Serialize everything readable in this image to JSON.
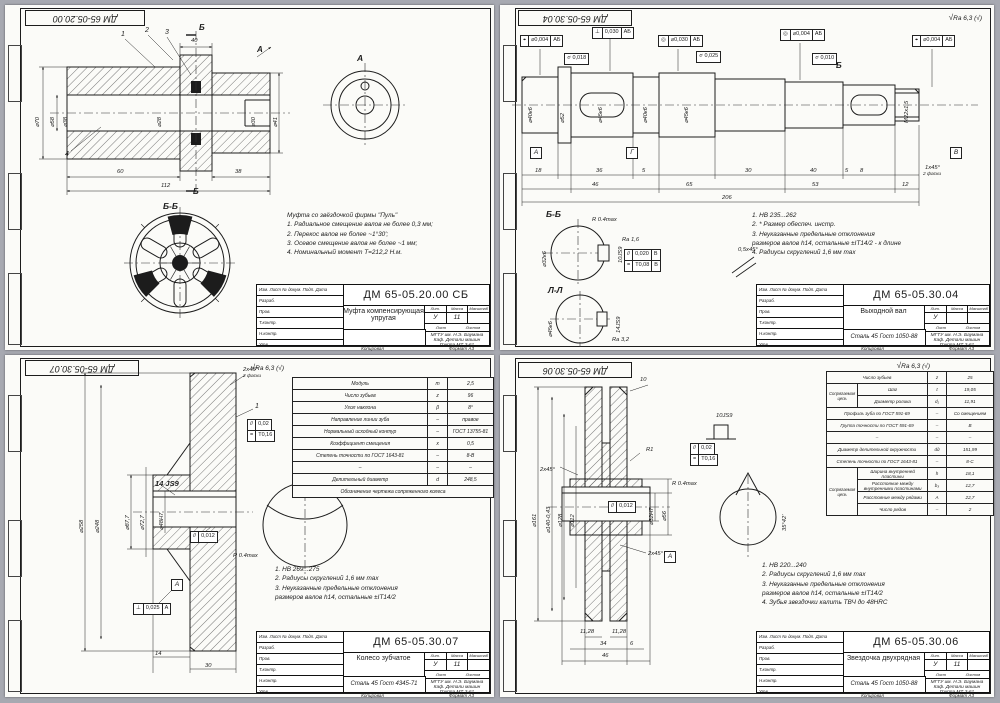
{
  "tbc": {
    "r0": "Изм. Лист  № докум.  Подп.  Дата",
    "r1": "Разраб.",
    "r2": "Пров.",
    "r3": "Т.контр.",
    "r4": "Н.контр.",
    "r5": "Утв.",
    "lit": "Лит.",
    "mass": "Масса",
    "scale": "Масштаб",
    "sheet": "Лист",
    "sheets": "Листов",
    "org1": "МГТУ им. Н.Э. Баумана",
    "org2": "Каф. Детали машин",
    "org3": "Группа МТ 3-61",
    "copied": "Копировал",
    "format": "Формат А3",
    "check": "√",
    "rough": "Ra 6,3 (√)"
  },
  "s1": {
    "corner": "ДМ 65-05.20.00",
    "labels": {
      "viewA": "А",
      "cutTop": "Б",
      "cutBottom": "Б",
      "section": "Б-Б",
      "arrowA": "А"
    },
    "callouts": [
      "1",
      "2",
      "3",
      "4"
    ],
    "dims": {
      "w40": "40",
      "d70": "⌀70",
      "d58": "⌀58",
      "d38": "⌀38",
      "d28": "⌀28",
      "d30": "⌀30",
      "d41": "⌀41",
      "l60": "60",
      "l112": "112",
      "l38": "38"
    },
    "notes": [
      "Муфта со звёздочкой фирмы \"Пуль\"",
      "1. Радиальное смещение валов не более 0,3 мм;",
      "2. Перекос валов не более ~1°30';",
      "3. Осевое смещение валов не более ~1 мм;",
      "4. Номинальный момент Т=212,2 Н.м."
    ],
    "tb": {
      "doc": "ДМ 65-05.20.00 СБ",
      "name": "Муфта компенсирующая упругая",
      "material": "",
      "lit": "У",
      "mass": "11",
      "scale": ""
    }
  },
  "s2": {
    "corner": "ДМ 65-05.30.04",
    "frames": {
      "f1s": "⌖",
      "f1v": "⌀0,004",
      "f1d": "АБ",
      "f2s": "⊥",
      "f2v": "0,030",
      "f2d": "АБ",
      "f3s": "◎",
      "f3v": "⌀0,030",
      "f3d": "АБ",
      "f4s": "◎",
      "f4v": "⌀0,004",
      "f4d": "АБ",
      "f5s": "⌖",
      "f5v": "⌀0,004",
      "f5d": "АБ",
      "f6": "⌭ 0,018",
      "f7": "⌭ 0,025",
      "f8": "⌭ 0,010",
      "k1s": "//",
      "k1v": "0,020",
      "k1d": "В",
      "k2s": "=",
      "k2v": "Т0,08",
      "k2d": "В"
    },
    "dims": {
      "d1": "⌀40к6",
      "d2": "⌀52",
      "d3": "⌀45к6",
      "d4": "⌀40к6",
      "d5": "⌀45к6",
      "thread": "М22х1,5",
      "b18": "18",
      "b36": "36",
      "b5a": "5",
      "b30": "30",
      "b40": "40",
      "b5b": "5",
      "b8": "8",
      "b46": "46",
      "b65": "65",
      "b53": "53",
      "b12": "12",
      "b206": "206",
      "cham": "1х45°",
      "cham2": "2 фаски",
      "chamd": "0,5х45°",
      "sb": "⌀32к6",
      "sbk": "10JS9",
      "sbr": "R 0.4max",
      "sbra": "Ra 1,6",
      "sl": "⌀45к6",
      "slk": "14JS9",
      "slra": "Ra 3,2"
    },
    "labels": {
      "secB": "Б-Б",
      "secL": "Л-Л",
      "dA": "А",
      "dG": "Г",
      "dB": "В",
      "cutB": "Б"
    },
    "notes": [
      "1. НВ 235...262",
      "2. * Размер обеспеч. инстр.",
      "3. Неуказанные предельные отклонения",
      "размеров валов h14, остальные ±IT14/2 - к длине",
      "4. Радиусы скруглений 1,6 мм max"
    ],
    "tb": {
      "doc": "ДМ 65-05.30.04",
      "name": "Выходной вал",
      "material": "Сталь 45 Гост 1050-88",
      "lit": "У",
      "mass": "",
      "scale": ""
    }
  },
  "s3": {
    "corner": "ДМ 65-05.30.07",
    "table": [
      [
        "Модуль",
        "m",
        "2,5"
      ],
      [
        "Число зубьев",
        "z",
        "96"
      ],
      [
        "Угол наклона",
        "β",
        "8°"
      ],
      [
        "Направление линии зуба",
        "–",
        "правое"
      ],
      [
        "Нормальный исходный контур",
        "–",
        "ГОСТ 13755-81"
      ],
      [
        "Коэффициент смещения",
        "x",
        "0,5"
      ],
      [
        "Степень точности по ГОСТ 1643-81",
        "–",
        "8-В"
      ],
      [
        "–",
        "–",
        "–"
      ],
      [
        "Делительный диаметр",
        "d",
        "248,5"
      ],
      [
        "Обозначение чертежа сопряженного колеса"
      ]
    ],
    "dims": {
      "d258": "⌀258",
      "d248": "⌀248",
      "d877": "⌀87,7",
      "d727": "⌀72,7",
      "d48": "⌀48Н7",
      "key": "14 JS9",
      "cham": "2х45°",
      "cham2": "2 фаски",
      "w30": "30",
      "w14": "14",
      "r04": "R 0.4max",
      "c1": "1"
    },
    "frames": {
      "p1s": "//",
      "p1v": "0,012",
      "p2s": "⊥",
      "p2v": "0,025",
      "p2d": "А",
      "q1s": "//",
      "q1v": "0,02",
      "q2s": "=",
      "q2v": "Т0,16",
      "dA": "А"
    },
    "notes": [
      "1. НВ 269...275",
      "2. Радиусы скруглений 1,6 мм max",
      "3. Неуказанные предельные отклонения",
      "размеров валов h14, остальные ±IT14/2"
    ],
    "tb": {
      "doc": "ДМ 65-05.30.07",
      "name": "Колесо зубчатое",
      "material": "Сталь 45 Гост 4345-71",
      "lit": "У",
      "mass": "11",
      "scale": ""
    }
  },
  "s4": {
    "corner": "ДМ 65-05.30.06",
    "table": {
      "g1": "Сопрягаемая цепь",
      "g2": "Сопрягаемая цепь",
      "r0": [
        "Число зубьев",
        "z",
        "25"
      ],
      "r1": [
        "Шаг",
        "t",
        "19,05"
      ],
      "r2": [
        "Диаметр ролика",
        "d₁",
        "11,91"
      ],
      "r3": [
        "Профиль зуба по ГОСТ 591-69",
        "–",
        "Со смещением"
      ],
      "r4": [
        "Группа точности по ГОСТ 591-69",
        "–",
        "В"
      ],
      "r5": [
        "–",
        "–",
        "–"
      ],
      "r6": [
        "Диаметр делительной окружности",
        "dд",
        "151,99"
      ],
      "r7": [
        "Степень точности по ГОСТ 1643-81",
        "–",
        "8-С"
      ],
      "r8": [
        "Ширина внутренней пластины",
        "h",
        "18,1"
      ],
      "r9": [
        "Расстояние между внутренними пластинами",
        "b₃",
        "12,7"
      ],
      "r10": [
        "Расстояние между рядами",
        "А",
        "22,7"
      ],
      "r11": [
        "Число рядов",
        "–",
        "2"
      ]
    },
    "dims": {
      "d161": "⌀161",
      "d140": "⌀140-0,43",
      "d128": "⌀128",
      "d112": "⌀112",
      "d32": "⌀32Н7",
      "d56": "⌀56",
      "cham": "2х45°",
      "key": "10JS9",
      "ang": "35°42'",
      "r1": "R1",
      "r04": "R 0.4max",
      "t10": "10",
      "b1": "11,28",
      "b2": "34",
      "b3": "6",
      "b4": "11,28",
      "b5": "46"
    },
    "frames": {
      "q1s": "//",
      "q1v": "0,02",
      "q2s": "=",
      "q2v": "Т0,16",
      "p1s": "//",
      "p1v": "0,012",
      "dA": "А"
    },
    "notes": [
      "1. НВ 220...240",
      "2. Радиусы скруглений 1,6 мм max",
      "3. Неуказанные предельные отклонения",
      "размеров валов h14, остальные ±IT14/2",
      "4. Зубья звездочки калить ТВЧ до 48HRC"
    ],
    "tb": {
      "doc": "ДМ 65-05.30.06",
      "name": "Звездочка двухрядная",
      "material": "Сталь 45 Гост 1050-88",
      "lit": "У",
      "mass": "11",
      "scale": ""
    }
  }
}
